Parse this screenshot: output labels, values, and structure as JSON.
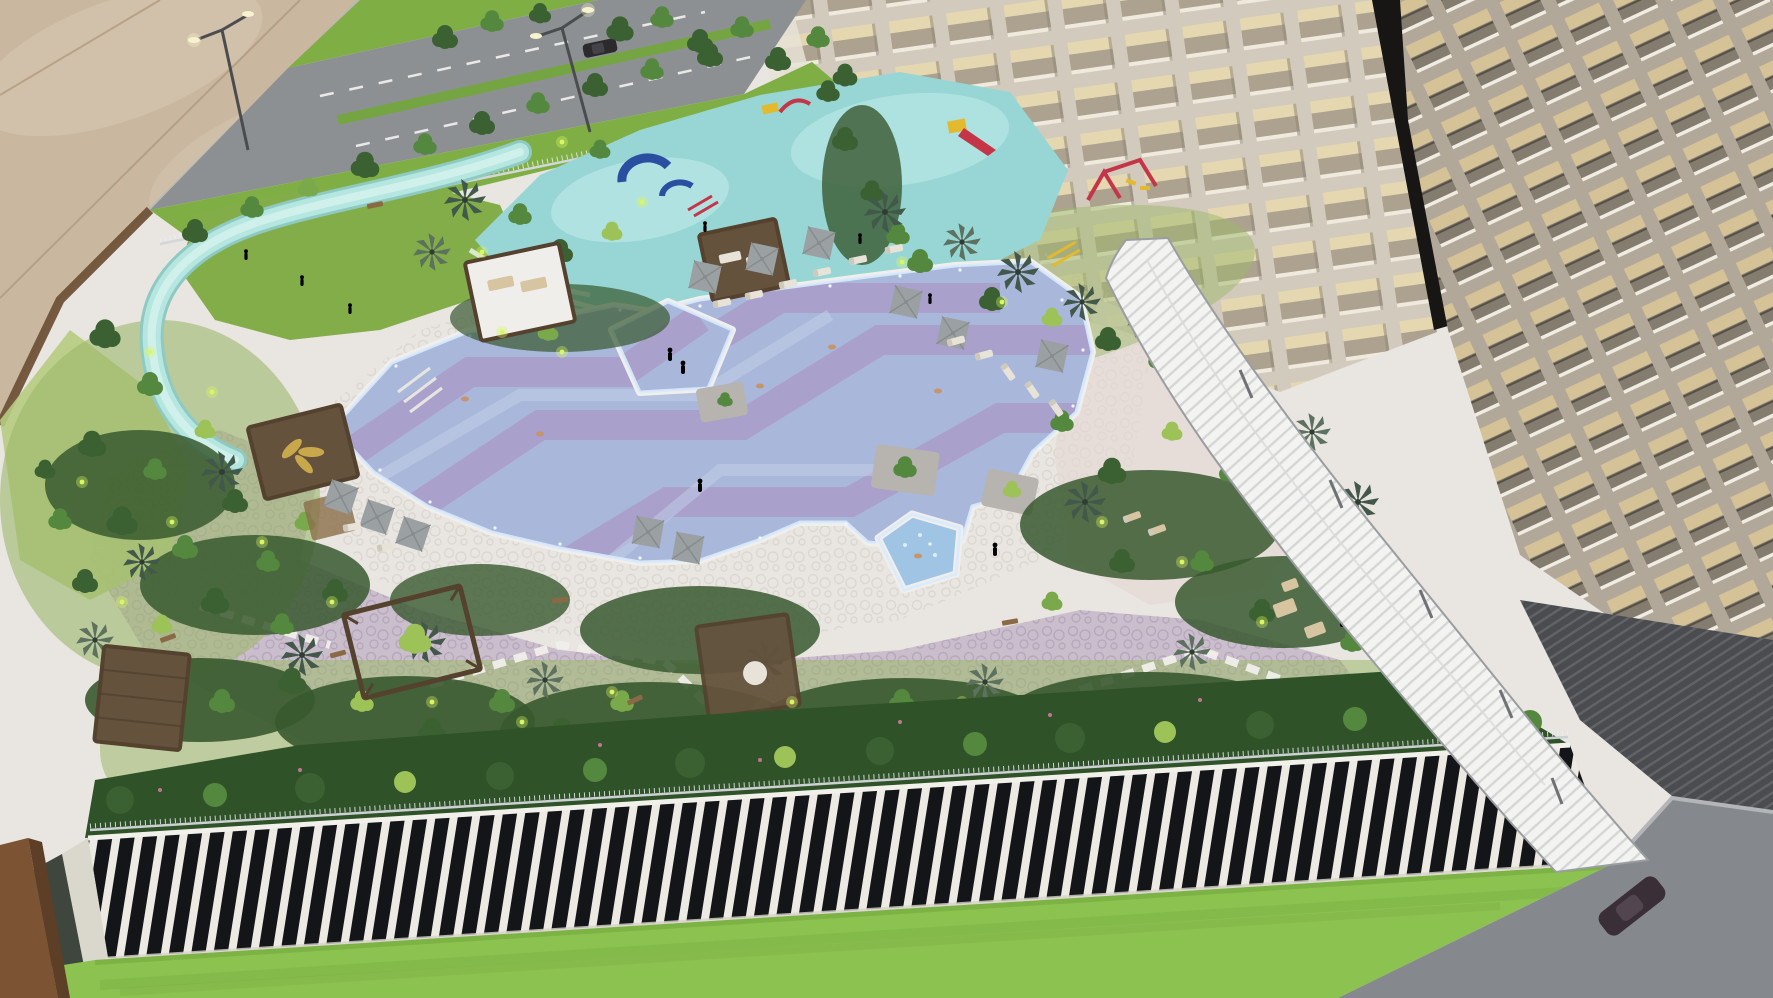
{
  "scene": {
    "type": "photograph",
    "subject": "Aerial view of an illuminated architectural scale model of a residential resort complex displayed in a sales gallery",
    "elements": [
      "beige showroom floor with tile joints",
      "perimeter road with white dashed lane markings, green median and verges",
      "street lamps with lit heads and a dark car",
      "silver boundary fence with street trees",
      "teal lazy river looping around a lawn",
      "children's aqua playground in light teal with red, yellow and blue play equipment",
      "free-form swimming pool with light blue mosaic water and lavender geometric bands",
      "rotated square plunge pool and pentagonal jacuzzi with glowing white rims",
      "white pebble-mosaic pool deck and lavender garden paving with stepping-stone paths",
      "dense model trees, palms, shrubs and tiny green accent lights",
      "timber cabanas and pergolas, one with a golden leaf-motif roof",
      "gray square parasols with sun loungers and miniature human figures",
      "two cream high-rise towers with warm-lit grid facades and a dark gap between them",
      "long curved white louvered drop-off canopy along the right tower",
      "podium roof hedge with glass railing over a facade of white vertical fins and dark glass",
      "bright green base lawn, gray driveway with a dark car, wooden display post"
    ]
  },
  "colors": {
    "floor": "#c9b7a0",
    "floor_light": "#d9c9b3",
    "floor_joint": "#b09a80",
    "rim_brown": "#6f5238",
    "curb": "#b7bab4",
    "road": "#8d9093",
    "road_dash": "#e9e9e7",
    "verge": "#7fae45",
    "median": "#75a542",
    "fence": "#d3d7da",
    "ground": "#9db86a",
    "meadow": "#b6cc81",
    "lawn": "#83ad48",
    "river": "#b5e7e0",
    "river_dark": "#8fcac2",
    "river_light": "#d9f4ef",
    "playground": "#97d6d4",
    "playground_light": "#c5edeb",
    "wave_white": "#edf7f5",
    "deck": "#e9e5e0",
    "deck_pebble": "#cfc8c0",
    "deck_pink": "#e4d9d4",
    "paving": "#c8bccb",
    "paving_pebble": "#a795ad",
    "path_stone": "#f0eeea",
    "pool_water": "#a9b8da",
    "pool_water_light": "#c4cfe9",
    "pool_band": "#a99bc9",
    "pool_rim": "#f1efec",
    "pool_glow": "#d9eafc",
    "pool_sparkle": "#eef6ff",
    "jacuzzi": "#9fc4e4",
    "planter": "#b7b3ae",
    "tree_dark": "#3b6132",
    "tree_mid": "#54883f",
    "tree_light": "#79a94a",
    "tree_lime": "#9cc258",
    "palm_dark": "#42584a",
    "palm_gray": "#5d715f",
    "shrub": "#38592f",
    "hedge": "#2f5229",
    "accent_light": "#d9f763",
    "flower_pink": "#d77fa2",
    "pergola": "#54422f",
    "pergola_roof": "#efeeea",
    "pergola_roof_dark": "#64523d",
    "pergola_gold": "#c9a84c",
    "umbrella": "#9ba0a2",
    "umbrella_dark": "#878c8e",
    "lounger": "#e8e3d8",
    "lounger_tan": "#d7c5a2",
    "bench": "#8a6a45",
    "skin": "#c7946c",
    "figure_red": "#c0392b",
    "figure_blue": "#2f5d8a",
    "tower1_facade": "#d2cabd",
    "tower1_window": "#aca28f",
    "tower1_lit": "#e5d8b0",
    "tower1_sill": "#efeadd",
    "tower1_shadow": "#8f8678",
    "tower_gap": "#171614",
    "tower2_facade": "#b2a89a",
    "tower2_window_lit": "#d5c297",
    "tower2_window_dark": "#837c6f",
    "tower2_sill": "#f1ece2",
    "tower2_rail": "#564f45",
    "canopy": "#f3f3f1",
    "canopy_slat": "#bcbfc0",
    "canopy_edge": "#9a9da0",
    "base_ribbed": "#4b4c50",
    "base_rib_line": "#626368",
    "drive": "#85888c",
    "drive_curb": "#b3b5b8",
    "car_dark": "#3a2f37",
    "podium_fin": "#eceae3",
    "podium_glass": "#141518",
    "railing": "#ccd0d3",
    "podium_corner": "#dad7cd",
    "podium_side": "#3f463e",
    "base_lawn": "#8cc24f",
    "base_lawn_dark": "#6da23c",
    "post": "#7c5434",
    "post_dark": "#5d3e26",
    "lamp": "#4a4c4e",
    "lamp_light": "#f7f3cf",
    "play_red": "#c53548",
    "play_yellow": "#e3b92e",
    "play_blue": "#2b4fa0"
  }
}
